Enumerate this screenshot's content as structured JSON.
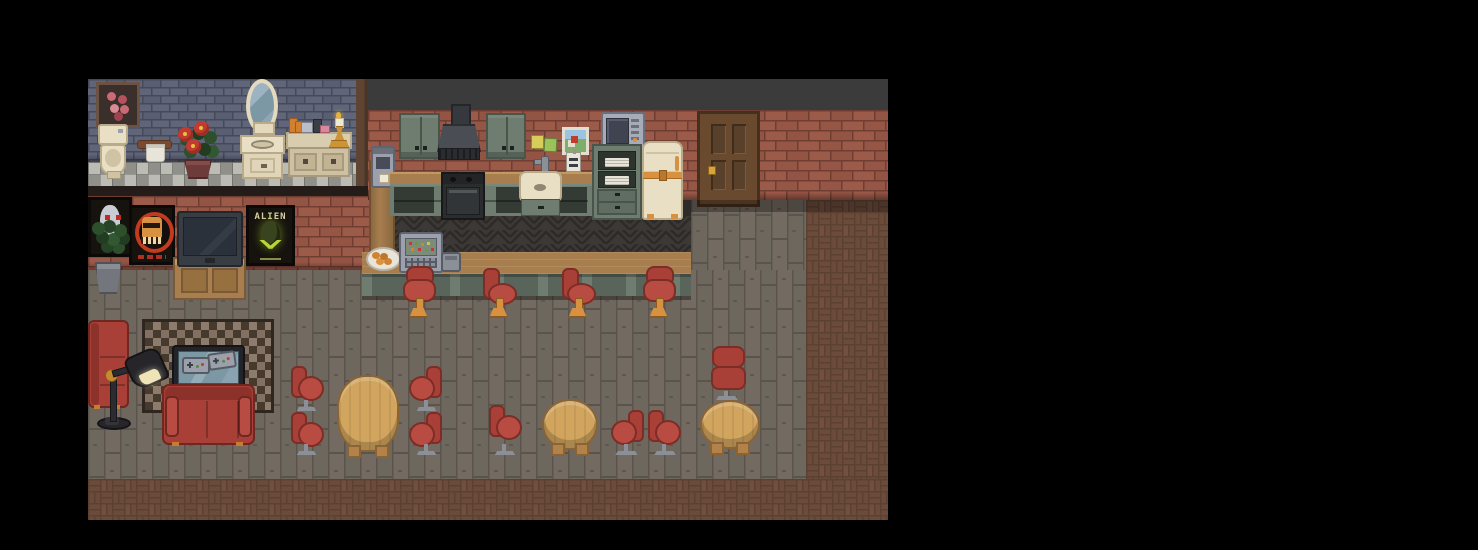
{
  "scene": {
    "title": "Pixel-art cafe apartment interior",
    "description": "Top-down pixel art room with bathroom (top-left), kitchen with bar counter (top-middle), lounge with TV and couches (left), and dining tables with red chairs (bottom)",
    "viewport": {
      "rect": [
        88,
        79,
        800,
        441
      ]
    }
  },
  "posters": {
    "alien_text": "ALIEN"
  },
  "palette": {
    "background": "#000000",
    "band": "#3b3b3b",
    "brick": "#9c5a49",
    "brick_mortar": "#6f3d31",
    "brick_dark": "#8a4d3e",
    "bath_brick": "#60657a",
    "bath_mortar": "#454a59",
    "check_a": "#bcbcb4",
    "check_b": "#8f9089",
    "check_line": "#73746f",
    "divider": "#5d4433",
    "edge_dark": "#241c19",
    "plank": "#6e675e",
    "plank_hi": "#766e64",
    "plank_seam": "#5a544c",
    "chevron": "#3b3835",
    "chevron_dark": "#2d2a28",
    "paver": "#6d4b3b",
    "paver_mortar": "#5a4132",
    "wood": "#a87e4e",
    "wood_dark": "#7a5a36",
    "wood_hi": "#c09a62",
    "cab": "#6f7d71",
    "cab_dark": "#49544b",
    "cab_face": "#343b35",
    "cream": "#e9dfc4",
    "cream_dark": "#cfc3a4",
    "cream_edge": "#b9ab8a",
    "orange": "#d89140",
    "red": "#a84038",
    "red_dark": "#7c2d26",
    "red_hi": "#b84c42",
    "base_gray": "#8a8f98",
    "tan": "#d2a55f",
    "tan_edge": "#8a6434",
    "tan_dark": "#b2824a",
    "rug_a": "#46392e",
    "rug_b": "#8d7c6b",
    "rug_border": "#2f2620",
    "steel": "#9ba0ac",
    "steel_dark": "#565b63",
    "steel_deep": "#474c58",
    "door": "#6a4a2f",
    "door_dark": "#59402a",
    "door_edge": "#452f1d",
    "knob": "#d8a33c",
    "poster_bg": "#16120e",
    "poster_text": "#d8cfa2",
    "lime": "#b8d435",
    "egg": "#39441f",
    "screen": "#2b313a",
    "white": "#e8e4da",
    "leaf": "#2e4f2c",
    "leaf_dark": "#223c22",
    "pot_maroon": "#6e3b3b",
    "pot_gray": "#73767c",
    "glass": "#7d98a5",
    "lamp_black": "#26262a",
    "lamp_light": "#efe3b8"
  },
  "objects": {
    "top_band": {
      "label": "dark ceiling band",
      "rect": [
        280,
        0,
        520,
        31
      ]
    },
    "bath_wall": {
      "label": "bathroom gray brick wall",
      "rect": [
        0,
        0,
        268,
        83
      ]
    },
    "bath_floor": {
      "label": "bathroom checker tile floor",
      "rect": [
        0,
        83,
        268,
        26
      ]
    },
    "divider": {
      "label": "wooden wall divider",
      "rect": [
        268,
        0,
        12,
        111
      ]
    },
    "lounge_wall_edge": {
      "label": "wall base shadow strip",
      "rect": [
        0,
        107,
        281,
        10
      ]
    },
    "lounge_wall": {
      "label": "lounge red brick wall",
      "rect": [
        0,
        117,
        281,
        74
      ]
    },
    "kitchen_wall": {
      "label": "kitchen red brick wall",
      "rect": [
        280,
        31,
        520,
        90
      ]
    },
    "floor_main": {
      "label": "wood plank floor",
      "rect": [
        0,
        191,
        718,
        209
      ]
    },
    "floor_door": {
      "label": "wood plank floor by door",
      "rect": [
        603,
        121,
        115,
        70
      ]
    },
    "floor_brick_right": {
      "label": "brick paver floor right",
      "rect": [
        718,
        121,
        82,
        279
      ]
    },
    "floor_brick_bottom": {
      "label": "brick paver floor bottom",
      "rect": [
        0,
        400,
        800,
        41
      ]
    },
    "behind_bar_floor": {
      "label": "dark floor behind bar",
      "rect": [
        302,
        137,
        301,
        38
      ]
    },
    "bar_sliver": {
      "label": "shadow beside fridge",
      "rect": [
        591,
        121,
        12,
        16
      ]
    },
    "rose_picture": {
      "label": "framed rose picture",
      "rect": [
        8,
        3,
        38,
        40
      ]
    },
    "toilet": {
      "label": "toilet",
      "rect": [
        9,
        45,
        32,
        55
      ]
    },
    "towel_ring": {
      "label": "towel holder",
      "rect": [
        49,
        59,
        35,
        24
      ]
    },
    "flower_plant": {
      "label": "potted red flower plant",
      "rect": [
        88,
        40,
        44,
        60
      ]
    },
    "mirror": {
      "label": "oval vanity mirror",
      "rect": [
        154,
        0,
        40,
        56
      ]
    },
    "sink_vanity": {
      "label": "bathroom sink vanity",
      "rect": [
        152,
        56,
        45,
        44
      ]
    },
    "side_counter": {
      "label": "bathroom counter cabinet",
      "rect": [
        198,
        53,
        66,
        49
      ]
    },
    "toiletries": {
      "label": "toiletry bottles",
      "rect": [
        201,
        37,
        40,
        17
      ]
    },
    "candlestick": {
      "label": "gold candlestick",
      "rect": [
        240,
        33,
        20,
        36
      ]
    },
    "creepy_poster": {
      "label": "pale face poster",
      "rect": [
        0,
        118,
        38,
        54
      ]
    },
    "robot_poster": {
      "label": "orange robot poster",
      "rect": [
        41,
        126,
        40,
        54
      ]
    },
    "tv_stand": {
      "label": "wooden tv stand",
      "rect": [
        85,
        178,
        69,
        39
      ]
    },
    "tv": {
      "label": "television",
      "rect": [
        89,
        132,
        62,
        52
      ]
    },
    "alien_poster": {
      "label": "alien movie poster",
      "rect": [
        158,
        126,
        43,
        55
      ]
    },
    "plant2": {
      "label": "potted plant",
      "rect": [
        0,
        141,
        42,
        74
      ]
    },
    "coffee_pillar": {
      "label": "counter end pillar",
      "rect": [
        281,
        81,
        22,
        95
      ]
    },
    "coffee_machine": {
      "label": "espresso machine",
      "rect": [
        283,
        67,
        20,
        38
      ]
    },
    "counter_top": {
      "label": "kitchen counter top",
      "rect": [
        302,
        93,
        202,
        12
      ]
    },
    "lower_cabinets": {
      "label": "kitchen lower cabinets",
      "rect": [
        302,
        105,
        202,
        32
      ]
    },
    "stove": {
      "label": "stove oven",
      "rect": [
        353,
        93,
        40,
        44
      ]
    },
    "sink_unit": {
      "label": "kitchen sink",
      "rect": [
        431,
        77,
        43,
        60
      ]
    },
    "upper_cab_1": {
      "label": "upper cabinet left",
      "rect": [
        311,
        34,
        37,
        42
      ]
    },
    "range_hood": {
      "label": "range hood",
      "rect": [
        349,
        25,
        44,
        58
      ]
    },
    "upper_cab_2": {
      "label": "upper cabinet right",
      "rect": [
        398,
        34,
        36,
        42
      ]
    },
    "sticky_note_yellow": {
      "label": "yellow sticky note",
      "rect": [
        443,
        56,
        11,
        12
      ]
    },
    "sticky_note_green": {
      "label": "green sticky note",
      "rect": [
        456,
        59,
        11,
        12
      ]
    },
    "wall_picture": {
      "label": "small framed landscape",
      "rect": [
        474,
        48,
        21,
        22
      ]
    },
    "wall_sign": {
      "label": "hanging menu sign",
      "rect": [
        478,
        73,
        13,
        18
      ]
    },
    "microwave": {
      "label": "microwave",
      "rect": [
        513,
        33,
        40,
        34
      ]
    },
    "hutch": {
      "label": "dish hutch cabinet",
      "rect": [
        504,
        65,
        46,
        72
      ]
    },
    "fridge": {
      "label": "retro cream fridge",
      "rect": [
        554,
        62,
        37,
        75
      ]
    },
    "door": {
      "label": "wooden entry door",
      "rect": [
        609,
        32,
        57,
        90
      ]
    },
    "bar_counter": {
      "label": "bar counter",
      "rect": [
        274,
        173,
        329,
        44
      ]
    },
    "register": {
      "label": "cash register",
      "rect": [
        311,
        153,
        40,
        37
      ]
    },
    "plate": {
      "label": "plate of pastries",
      "rect": [
        278,
        168,
        31,
        20
      ]
    },
    "card_reader": {
      "label": "card reader",
      "rect": [
        353,
        173,
        16,
        16
      ]
    },
    "stool_1": {
      "label": "bar stool 1",
      "rect": [
        315,
        187,
        31,
        51
      ]
    },
    "stool_2": {
      "label": "bar stool 2",
      "rect": [
        395,
        187,
        31,
        51
      ]
    },
    "stool_3": {
      "label": "bar stool 3",
      "rect": [
        474,
        187,
        31,
        51
      ]
    },
    "stool_4": {
      "label": "bar stool 4",
      "rect": [
        555,
        187,
        31,
        51
      ]
    },
    "rug": {
      "label": "checkered rug",
      "rect": [
        54,
        240,
        126,
        88
      ]
    },
    "couch_vertical": {
      "label": "red couch left",
      "rect": [
        0,
        241,
        37,
        84
      ]
    },
    "coffee_table": {
      "label": "glass coffee table",
      "rect": [
        84,
        266,
        69,
        41
      ]
    },
    "controller_1": {
      "label": "game controller 1",
      "rect": []
    },
    "controller_2": {
      "label": "game controller 2",
      "rect": []
    },
    "couch_horizontal": {
      "label": "red couch bottom",
      "rect": [
        74,
        305,
        89,
        57
      ]
    },
    "floor_lamp": {
      "label": "black floor lamp",
      "rect": [
        7,
        271,
        70,
        80
      ]
    },
    "chair_a1": {
      "label": "dining chair",
      "rect": [
        203,
        287,
        31,
        45
      ]
    },
    "chair_a2": {
      "label": "dining chair",
      "rect": [
        203,
        333,
        31,
        43
      ]
    },
    "table_a": {
      "label": "oval dining table",
      "rect": [
        249,
        296,
        62,
        83
      ]
    },
    "chair_a3": {
      "label": "dining chair",
      "rect": [
        323,
        287,
        31,
        45
      ]
    },
    "chair_a4": {
      "label": "dining chair",
      "rect": [
        323,
        333,
        31,
        43
      ]
    },
    "chair_b1": {
      "label": "dining chair",
      "rect": [
        401,
        326,
        32,
        50
      ]
    },
    "table_b": {
      "label": "round dining table",
      "rect": [
        454,
        320,
        56,
        57
      ]
    },
    "chair_b2": {
      "label": "dining chair",
      "rect": [
        521,
        331,
        35,
        45
      ]
    },
    "chair_c1": {
      "label": "dining chair",
      "rect": [
        560,
        331,
        34,
        45
      ]
    },
    "chair_c2": {
      "label": "dining chair top",
      "rect": [
        622,
        267,
        34,
        54
      ]
    },
    "table_c": {
      "label": "round dining table",
      "rect": [
        612,
        321,
        60,
        55
      ]
    }
  }
}
